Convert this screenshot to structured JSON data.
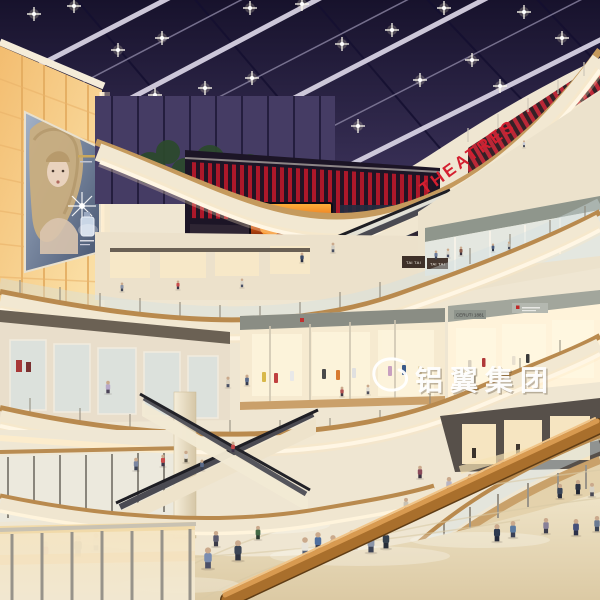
{
  "scene": {
    "description": "Architectural rendering of a multi-level shopping mall atrium at evening: dark glazed skylight with diagonal beams and spotlights, curved cream-and-wood balcony fascias with LED cove lighting, criss-crossing escalators, glowing amber panel wall with a backlit perfume billboard, red cinema level, storefronts with mannequins, and shoppers on polished beige floors.",
    "watermark": {
      "symbol": "swirl-logo",
      "text": "铝翼集团"
    },
    "signs": {
      "theatres": {
        "label": "THEATRES",
        "color": "#d41f30"
      },
      "tai_tai_left": {
        "label": "TAI TAI"
      },
      "tai_tai_right": {
        "label": "TAI TAI"
      },
      "fascia_store": {
        "label": "CERUTI 1881"
      }
    },
    "billboard": {
      "subject": "backlit perfume advertisement with blonde model and bottle"
    },
    "palette": {
      "skylight": "#241d3e",
      "beam": "#d6d1e2",
      "fascia_cream": "#f2e8d2",
      "wood": "#b98a4e",
      "amber_wall": "#f6c77e",
      "theatres_red": "#d41f30",
      "slat_red": "#b5182a",
      "fire_orange": "#ff7a1a",
      "floor_beige": "#e7dabd",
      "handrail_wood": "#a96f2c",
      "glass_purple": "#4a4266",
      "tree_green": "#2e4d2e"
    },
    "ceiling_lights": [
      [
        34,
        14
      ],
      [
        118,
        50
      ],
      [
        205,
        88
      ],
      [
        74,
        6
      ],
      [
        162,
        38
      ],
      [
        252,
        78
      ],
      [
        308,
        114
      ],
      [
        250,
        8
      ],
      [
        342,
        44
      ],
      [
        420,
        80
      ],
      [
        302,
        4
      ],
      [
        392,
        30
      ],
      [
        472,
        60
      ],
      [
        524,
        12
      ],
      [
        562,
        38
      ],
      [
        444,
        8
      ],
      [
        500,
        86
      ],
      [
        358,
        126
      ],
      [
        155,
        95
      ],
      [
        268,
        128
      ]
    ],
    "people": [
      [
        524,
        147,
        7,
        "#c8ccd8",
        "#3a4050"
      ],
      [
        122,
        291,
        9,
        "#8a93a6",
        "#3f4454"
      ],
      [
        178,
        289,
        9,
        "#c74a4a",
        "#3a3448"
      ],
      [
        242,
        287,
        9,
        "#d9d4c8",
        "#4a5066"
      ],
      [
        302,
        262,
        10,
        "#3c4a66",
        "#2a3044"
      ],
      [
        333,
        252,
        10,
        "#cfccc2",
        "#4a5062"
      ],
      [
        436,
        259,
        9,
        "#6a7a9a",
        "#3c4456"
      ],
      [
        448,
        257,
        9,
        "#d8d4c8",
        "#4a5066"
      ],
      [
        461,
        255,
        9,
        "#8a5a4a",
        "#3c3440"
      ],
      [
        493,
        251,
        8,
        "#4a5a7a",
        "#2e3446"
      ],
      [
        509,
        249,
        8,
        "#c2beb2",
        "#484e5e"
      ],
      [
        342,
        396,
        10,
        "#b05050",
        "#403844"
      ],
      [
        368,
        394,
        10,
        "#e0dcd2",
        "#50505c"
      ],
      [
        108,
        393,
        13,
        "#b8a8c8",
        "#4c4458"
      ],
      [
        228,
        387,
        11,
        "#d8d0c0",
        "#4a5064"
      ],
      [
        247,
        385,
        11,
        "#5a6a8a",
        "#363c4e"
      ],
      [
        136,
        470,
        13,
        "#7a86a0",
        "#3c4254"
      ],
      [
        163,
        466,
        12,
        "#c84a4a",
        "#3c3448"
      ],
      [
        186,
        462,
        12,
        "#e0dcd2",
        "#565043"
      ],
      [
        202,
        470,
        11,
        "#5a6a8a",
        "#3a4054"
      ],
      [
        233,
        452,
        11,
        "#c84a4a",
        "#3c3448"
      ],
      [
        449,
        492,
        16,
        "#b8b4c2",
        "#4a4452"
      ],
      [
        470,
        488,
        15,
        "#30384a",
        "#23283a"
      ],
      [
        500,
        473,
        15,
        "#c7cdd8",
        "#3d434f"
      ],
      [
        560,
        498,
        15,
        "#384458",
        "#262c3a"
      ],
      [
        578,
        494,
        15,
        "#2c3242",
        "#1f2430"
      ],
      [
        592,
        496,
        14,
        "#d8d2c4",
        "#4a4a56"
      ],
      [
        420,
        478,
        13,
        "#8a4a5a",
        "#3c3040"
      ],
      [
        45,
        560,
        20,
        "#a83232",
        "#e8e4d8"
      ],
      [
        78,
        556,
        22,
        "#3a3a3a",
        "#2a2a2a"
      ],
      [
        96,
        550,
        18,
        "#d8d4c8",
        "#4a5568"
      ],
      [
        208,
        568,
        22,
        "#7a8db0",
        "#4b4f66"
      ],
      [
        238,
        560,
        21,
        "#3c4656",
        "#2e3340"
      ],
      [
        216,
        546,
        16,
        "#5a5a6e",
        "#3a3a48"
      ],
      [
        258,
        539,
        14,
        "#446a46",
        "#2c3a30"
      ],
      [
        305,
        556,
        20,
        "#e8e4da",
        "#5a6478"
      ],
      [
        318,
        550,
        19,
        "#4f6f9f",
        "#3a3f50"
      ],
      [
        333,
        553,
        19,
        "#7a6a5a",
        "#42382e"
      ],
      [
        352,
        548,
        19,
        "#3a4254",
        "#262c38"
      ],
      [
        371,
        552,
        20,
        "#8a94a8",
        "#3c4254"
      ],
      [
        386,
        548,
        19,
        "#34404e",
        "#262c38"
      ],
      [
        497,
        541,
        18,
        "#2e3a50",
        "#23283a"
      ],
      [
        513,
        537,
        17,
        "#5a7aa0",
        "#3a4054"
      ],
      [
        546,
        533,
        16,
        "#888098",
        "#3c3c4c"
      ],
      [
        576,
        535,
        17,
        "#45507a",
        "#2c3048"
      ],
      [
        597,
        531,
        16,
        "#6a7a92",
        "#3a4252"
      ],
      [
        406,
        511,
        14,
        "#c8c2b4",
        "#565043"
      ]
    ]
  }
}
